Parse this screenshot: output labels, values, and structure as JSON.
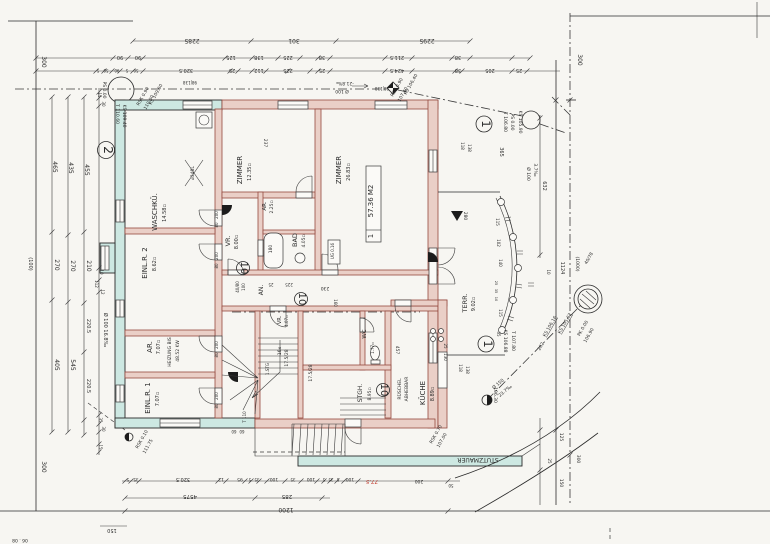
{
  "document": {
    "kind": "scanned architectural floor plan, ground floor, rotated scan"
  },
  "colors": {
    "paper": "#f7f6f2",
    "ink": "#2b2b2b",
    "exterior_wall": "#cde8e2",
    "interior_wall": "#eacfc7",
    "wall_edge": "#94493f",
    "red_mark": "#c0392b"
  },
  "apartment_box": {
    "line_area": "57.36 M2",
    "line_no": "1"
  },
  "circled_marks": [
    {
      "t": "2",
      "x": 106,
      "y": 150,
      "r": 8.5
    },
    {
      "t": "1",
      "x": 484,
      "y": 124,
      "r": 8
    },
    {
      "t": "1",
      "x": 486,
      "y": 344,
      "r": 8
    },
    {
      "t": "10",
      "x": 243,
      "y": 268,
      "r": 6.5
    },
    {
      "t": "10",
      "x": 301,
      "y": 299,
      "r": 6.5
    },
    {
      "t": "10",
      "x": 383,
      "y": 390,
      "r": 6.5
    }
  ],
  "labels": [
    {
      "t": "2285",
      "x": 192,
      "y": 39,
      "r": 180,
      "s": 6
    },
    {
      "t": "301",
      "x": 294,
      "y": 39,
      "r": 180,
      "s": 6
    },
    {
      "t": "2295",
      "x": 427,
      "y": 39,
      "r": 180,
      "s": 6
    },
    {
      "t": "90",
      "x": 120,
      "y": 56,
      "r": 180,
      "s": 5
    },
    {
      "t": "90",
      "x": 138,
      "y": 56,
      "r": 180,
      "s": 5
    },
    {
      "t": "125",
      "x": 231,
      "y": 56,
      "r": 180,
      "s": 5
    },
    {
      "t": "138",
      "x": 259,
      "y": 56,
      "r": 180,
      "s": 5
    },
    {
      "t": "225",
      "x": 288,
      "y": 56,
      "r": 180,
      "s": 5
    },
    {
      "t": "38",
      "x": 322,
      "y": 56,
      "r": 180,
      "s": 5
    },
    {
      "t": "211.5",
      "x": 397,
      "y": 56,
      "r": 180,
      "s": 5
    },
    {
      "t": "38",
      "x": 458,
      "y": 56,
      "r": 180,
      "s": 5
    },
    {
      "t": "5",
      "x": 98,
      "y": 69,
      "r": 180,
      "s": 4
    },
    {
      "t": "50",
      "x": 106,
      "y": 69,
      "r": 180,
      "s": 4
    },
    {
      "t": "90",
      "x": 117,
      "y": 69,
      "r": 180,
      "s": 4
    },
    {
      "t": "5",
      "x": 127,
      "y": 69,
      "r": 180,
      "s": 4
    },
    {
      "t": "50",
      "x": 136,
      "y": 69,
      "r": 180,
      "s": 4
    },
    {
      "t": "320.5",
      "x": 186,
      "y": 69,
      "r": 180,
      "s": 5
    },
    {
      "t": "25",
      "x": 232,
      "y": 69,
      "r": 180,
      "s": 5
    },
    {
      "t": "112",
      "x": 259,
      "y": 69,
      "r": 180,
      "s": 5
    },
    {
      "t": "225",
      "x": 288,
      "y": 69,
      "r": 180,
      "s": 5
    },
    {
      "t": "25",
      "x": 322,
      "y": 69,
      "r": 180,
      "s": 5
    },
    {
      "t": "424.5",
      "x": 397,
      "y": 69,
      "r": 180,
      "s": 5
    },
    {
      "t": "38",
      "x": 458,
      "y": 69,
      "r": 180,
      "s": 5
    },
    {
      "t": "205",
      "x": 490,
      "y": 69,
      "r": 180,
      "s": 5
    },
    {
      "t": "25",
      "x": 519,
      "y": 69,
      "r": 180,
      "s": 5
    },
    {
      "t": "98|138",
      "x": 190,
      "y": 81,
      "r": 180,
      "s": 4
    },
    {
      "t": "98|138",
      "x": 382,
      "y": 87,
      "r": 180,
      "s": 4
    },
    {
      "t": "300",
      "x": 42,
      "y": 62,
      "r": 90,
      "s": 6
    },
    {
      "t": "465",
      "x": 53,
      "y": 167,
      "r": 90,
      "s": 6
    },
    {
      "t": "435",
      "x": 69,
      "y": 168,
      "r": 90,
      "s": 6
    },
    {
      "t": "455",
      "x": 85,
      "y": 170,
      "r": 90,
      "s": 6
    },
    {
      "t": "270",
      "x": 55,
      "y": 265,
      "r": 90,
      "s": 6
    },
    {
      "t": "270",
      "x": 71,
      "y": 266,
      "r": 90,
      "s": 6
    },
    {
      "t": "210",
      "x": 87,
      "y": 266,
      "r": 90,
      "s": 6
    },
    {
      "t": "405",
      "x": 55,
      "y": 365,
      "r": 90,
      "s": 6
    },
    {
      "t": "545",
      "x": 71,
      "y": 365,
      "r": 90,
      "s": 6
    },
    {
      "t": "220.5",
      "x": 87,
      "y": 326,
      "r": 90,
      "s": 5
    },
    {
      "t": "220.5",
      "x": 87,
      "y": 386,
      "r": 90,
      "s": 5
    },
    {
      "t": "300",
      "x": 42,
      "y": 467,
      "r": 90,
      "s": 6
    },
    {
      "t": "(100)",
      "x": 29,
      "y": 264,
      "r": 90,
      "s": 5
    },
    {
      "t": "Ø 100  16.8‰",
      "x": 104,
      "y": 330,
      "r": 90,
      "s": 5
    },
    {
      "t": "15",
      "x": 98,
      "y": 95,
      "r": 90,
      "s": 4
    },
    {
      "t": "30",
      "x": 102,
      "y": 104,
      "r": 90,
      "s": 4
    },
    {
      "t": "10",
      "x": 100,
      "y": 272,
      "r": 90,
      "s": 4
    },
    {
      "t": "112",
      "x": 95,
      "y": 284,
      "r": 90,
      "s": 4
    },
    {
      "t": "12",
      "x": 101,
      "y": 292,
      "r": 90,
      "s": 4
    },
    {
      "t": "35",
      "x": 99,
      "y": 420,
      "r": 90,
      "s": 4
    },
    {
      "t": "30",
      "x": 102,
      "y": 429,
      "r": 90,
      "s": 4
    },
    {
      "t": "15",
      "x": 99,
      "y": 447,
      "r": 90,
      "s": 4
    },
    {
      "t": "PS 0.00",
      "x": 103,
      "y": 90,
      "r": 90,
      "s": 4.5
    },
    {
      "t": "T 110.60",
      "x": 116,
      "y": 114,
      "r": 90,
      "s": 4.5
    },
    {
      "t": "KS 109.40",
      "x": 123,
      "y": 116,
      "r": 90,
      "s": 4.5
    },
    {
      "t": "RSK 0.90",
      "x": 144,
      "y": 97,
      "r": -60,
      "s": 4.5
    },
    {
      "t": "110.00",
      "x": 150,
      "y": 103,
      "r": -60,
      "s": 4.5
    },
    {
      "t": "KS 109.60",
      "x": 157,
      "y": 95,
      "r": -60,
      "s": 4.5
    },
    {
      "t": "Ø 100",
      "x": 342,
      "y": 90,
      "r": 180,
      "s": 4.5
    },
    {
      "t": "-21.8‰",
      "x": 345,
      "y": 82,
      "r": 180,
      "s": 4.5
    },
    {
      "t": "RSK 0.90",
      "x": 398,
      "y": 88,
      "r": -60,
      "s": 4.5
    },
    {
      "t": "107.40",
      "x": 404,
      "y": 95,
      "r": -60,
      "s": 4.5
    },
    {
      "t": "KS 106.40",
      "x": 412,
      "y": 85,
      "r": -60,
      "s": 4.5
    },
    {
      "t": "T 106.80",
      "x": 504,
      "y": 122,
      "r": 90,
      "s": 4.5
    },
    {
      "t": "PS 0.00",
      "x": 511,
      "y": 122,
      "r": 90,
      "s": 4.5
    },
    {
      "t": "KS 105.90",
      "x": 519,
      "y": 122,
      "r": 90,
      "s": 4.5
    },
    {
      "t": "300",
      "x": 578,
      "y": 60,
      "r": 90,
      "s": 6
    },
    {
      "t": "365",
      "x": 500,
      "y": 152,
      "r": 90,
      "s": 5
    },
    {
      "t": "Ø 100",
      "x": 527,
      "y": 174,
      "r": 90,
      "s": 4.5
    },
    {
      "t": "3.7‰",
      "x": 534,
      "y": 170,
      "r": 90,
      "s": 4.5
    },
    {
      "t": "632",
      "x": 543,
      "y": 186,
      "r": 90,
      "s": 5
    },
    {
      "t": "118",
      "x": 461,
      "y": 146,
      "r": 90,
      "s": 4
    },
    {
      "t": "138",
      "x": 468,
      "y": 148,
      "r": 90,
      "s": 4
    },
    {
      "t": "WASCHKÜ.",
      "x": 157,
      "y": 212,
      "r": -90,
      "s": 7
    },
    {
      "t": "14.58▫",
      "x": 166,
      "y": 213,
      "r": -90,
      "s": 5
    },
    {
      "t": "ZIMMER",
      "x": 242,
      "y": 170,
      "r": -90,
      "s": 7
    },
    {
      "t": "12.35▫",
      "x": 251,
      "y": 172,
      "r": -90,
      "s": 5
    },
    {
      "t": "ZIMMER",
      "x": 341,
      "y": 170,
      "r": -90,
      "s": 7
    },
    {
      "t": "26.83▫",
      "x": 350,
      "y": 172,
      "r": -90,
      "s": 5
    },
    {
      "t": "EINL.R. 2",
      "x": 147,
      "y": 263,
      "r": -90,
      "s": 7
    },
    {
      "t": "8.62▫",
      "x": 156,
      "y": 264,
      "r": -90,
      "s": 5
    },
    {
      "t": "AR.",
      "x": 152,
      "y": 347,
      "r": -90,
      "s": 7
    },
    {
      "t": "7.07▫",
      "x": 160,
      "y": 347,
      "r": -90,
      "s": 5
    },
    {
      "t": "HEIZUNG BIS",
      "x": 171,
      "y": 352,
      "r": -90,
      "s": 4.5
    },
    {
      "t": "48.52 KW",
      "x": 179,
      "y": 351,
      "r": -90,
      "s": 4.5
    },
    {
      "t": "EINL.R. 1",
      "x": 150,
      "y": 398,
      "r": -90,
      "s": 7
    },
    {
      "t": "7.07▫",
      "x": 159,
      "y": 399,
      "r": -90,
      "s": 5
    },
    {
      "t": "VR.",
      "x": 230,
      "y": 241,
      "r": -90,
      "s": 6.5
    },
    {
      "t": "8.00▫",
      "x": 238,
      "y": 242,
      "r": -90,
      "s": 5
    },
    {
      "t": "AR.",
      "x": 266,
      "y": 206,
      "r": -90,
      "s": 5.5
    },
    {
      "t": "2.25▫",
      "x": 273,
      "y": 207,
      "r": -90,
      "s": 4.5
    },
    {
      "t": "BAD",
      "x": 297,
      "y": 240,
      "r": -90,
      "s": 6.5
    },
    {
      "t": "4.05▫",
      "x": 305,
      "y": 241,
      "r": -90,
      "s": 4.5
    },
    {
      "t": "AN.",
      "x": 263,
      "y": 290,
      "r": -90,
      "s": 6
    },
    {
      "t": "VR.",
      "x": 281,
      "y": 320,
      "r": -90,
      "s": 5
    },
    {
      "t": "4.07▫",
      "x": 288,
      "y": 321,
      "r": -90,
      "s": 4
    },
    {
      "t": "WC",
      "x": 366,
      "y": 334,
      "r": -90,
      "s": 5.5
    },
    {
      "t": "1.77▫",
      "x": 374,
      "y": 348,
      "r": -90,
      "s": 4
    },
    {
      "t": "STGH.",
      "x": 362,
      "y": 393,
      "r": -90,
      "s": 6
    },
    {
      "t": "8.95▫",
      "x": 371,
      "y": 394,
      "r": -90,
      "s": 4.5
    },
    {
      "t": "KÜCHE",
      "x": 425,
      "y": 393,
      "r": -90,
      "s": 7
    },
    {
      "t": "8.89▫",
      "x": 434,
      "y": 394,
      "r": -90,
      "s": 5
    },
    {
      "t": "TERR.",
      "x": 467,
      "y": 303,
      "r": -90,
      "s": 6.5
    },
    {
      "t": "9.02▫",
      "x": 475,
      "y": 304,
      "r": -90,
      "s": 5
    },
    {
      "t": "RÜSCHEL",
      "x": 401,
      "y": 389,
      "r": -90,
      "s": 4.5
    },
    {
      "t": "ABHEBBAR",
      "x": 408,
      "y": 389,
      "r": -90,
      "s": 4.5
    },
    {
      "t": "⌀348L",
      "x": 194,
      "y": 173,
      "r": -90,
      "s": 4.5
    },
    {
      "t": "180",
      "x": 272,
      "y": 249,
      "r": -90,
      "s": 4.5
    },
    {
      "t": "UG 0.16",
      "x": 334,
      "y": 251,
      "r": -90,
      "s": 4
    },
    {
      "t": "57.36 M2",
      "x": 373,
      "y": 201,
      "r": -90,
      "s": 7
    },
    {
      "t": "1",
      "x": 373,
      "y": 236,
      "r": -90,
      "s": 7
    },
    {
      "t": "237",
      "x": 264,
      "y": 143,
      "r": 90,
      "s": 4.5
    },
    {
      "t": "230",
      "x": 325,
      "y": 287,
      "r": 180,
      "s": 4.5
    },
    {
      "t": "225",
      "x": 289,
      "y": 283,
      "r": 180,
      "s": 4
    },
    {
      "t": "25",
      "x": 271,
      "y": 283,
      "r": 180,
      "s": 4
    },
    {
      "t": "160",
      "x": 334,
      "y": 303,
      "r": 90,
      "s": 4
    },
    {
      "t": "457",
      "x": 396,
      "y": 350,
      "r": 90,
      "s": 4.5
    },
    {
      "t": "130",
      "x": 444,
      "y": 357,
      "r": 90,
      "s": 4
    },
    {
      "t": "25",
      "x": 444,
      "y": 346,
      "r": 90,
      "s": 4
    },
    {
      "t": "200",
      "x": 218,
      "y": 215,
      "r": -90,
      "s": 4
    },
    {
      "t": "80",
      "x": 218,
      "y": 225,
      "r": -90,
      "s": 4
    },
    {
      "t": "200",
      "x": 218,
      "y": 256,
      "r": -90,
      "s": 4
    },
    {
      "t": "80",
      "x": 218,
      "y": 266,
      "r": -90,
      "s": 4
    },
    {
      "t": "200",
      "x": 218,
      "y": 345,
      "r": -90,
      "s": 4
    },
    {
      "t": "80",
      "x": 218,
      "y": 355,
      "r": -90,
      "s": 4
    },
    {
      "t": "200",
      "x": 218,
      "y": 396,
      "r": -90,
      "s": 4
    },
    {
      "t": "80",
      "x": 218,
      "y": 406,
      "r": -90,
      "s": 4
    },
    {
      "t": "40/80",
      "x": 239,
      "y": 287,
      "r": -90,
      "s": 4
    },
    {
      "t": "100",
      "x": 245,
      "y": 287,
      "r": -90,
      "s": 4
    },
    {
      "t": "16x",
      "x": 281,
      "y": 351,
      "r": -90,
      "s": 4.5
    },
    {
      "t": "17.5/28",
      "x": 288,
      "y": 358,
      "r": -90,
      "s": 4.5
    },
    {
      "t": "1.STG",
      "x": 269,
      "y": 369,
      "r": -90,
      "s": 4
    },
    {
      "t": "17.5/28",
      "x": 312,
      "y": 373,
      "r": -90,
      "s": 4.5
    },
    {
      "t": "T 110",
      "x": 246,
      "y": 417,
      "r": -90,
      "s": 4
    },
    {
      "t": "60",
      "x": 234,
      "y": 430,
      "r": 180,
      "s": 4
    },
    {
      "t": "60",
      "x": 242,
      "y": 430,
      "r": 180,
      "s": 4
    },
    {
      "t": "280",
      "x": 464,
      "y": 216,
      "r": 90,
      "s": 4.5
    },
    {
      "t": "115",
      "x": 496,
      "y": 222,
      "r": 90,
      "s": 4
    },
    {
      "t": "102",
      "x": 497,
      "y": 243,
      "r": 90,
      "s": 4
    },
    {
      "t": "140",
      "x": 499,
      "y": 263,
      "r": 90,
      "s": 4
    },
    {
      "t": "25",
      "x": 495,
      "y": 283,
      "r": 90,
      "s": 3.5
    },
    {
      "t": "35",
      "x": 495,
      "y": 291,
      "r": 90,
      "s": 3.5
    },
    {
      "t": "10",
      "x": 495,
      "y": 299,
      "r": 90,
      "s": 3.5
    },
    {
      "t": "115",
      "x": 499,
      "y": 313,
      "r": 90,
      "s": 4
    },
    {
      "t": "35",
      "x": 497,
      "y": 334,
      "r": 90,
      "s": 4
    },
    {
      "t": "1124",
      "x": 561,
      "y": 268,
      "r": 90,
      "s": 5
    },
    {
      "t": "(1000)",
      "x": 576,
      "y": 264,
      "r": 90,
      "s": 4.5
    },
    {
      "t": "10",
      "x": 547,
      "y": 272,
      "r": 90,
      "s": 4
    },
    {
      "t": "40/78",
      "x": 590,
      "y": 259,
      "r": -60,
      "s": 4.5
    },
    {
      "t": "KS 105.62",
      "x": 566,
      "y": 324,
      "r": -60,
      "s": 4.5,
      "c": "u"
    },
    {
      "t": "KS 106.16",
      "x": 551,
      "y": 327,
      "r": -60,
      "s": 4.5,
      "c": "u"
    },
    {
      "t": "282",
      "x": 542,
      "y": 347,
      "r": -60,
      "s": 4.5
    },
    {
      "t": "PK 0.00",
      "x": 584,
      "y": 329,
      "r": -60,
      "s": 4.5
    },
    {
      "t": "106.90",
      "x": 590,
      "y": 336,
      "r": -60,
      "s": 4.5
    },
    {
      "t": "KS 106.88",
      "x": 504,
      "y": 341,
      "r": 90,
      "s": 4.5
    },
    {
      "t": "T 107.80",
      "x": 512,
      "y": 341,
      "r": 90,
      "s": 4.5
    },
    {
      "t": "118",
      "x": 459,
      "y": 368,
      "r": 90,
      "s": 4
    },
    {
      "t": "138",
      "x": 466,
      "y": 370,
      "r": 90,
      "s": 4
    },
    {
      "t": "106.30",
      "x": 494,
      "y": 395,
      "r": 90,
      "s": 4.5
    },
    {
      "t": "Ø 150",
      "x": 499,
      "y": 385,
      "r": -40,
      "s": 4.5
    },
    {
      "t": "23.7‰",
      "x": 506,
      "y": 392,
      "r": -40,
      "s": 4.5
    },
    {
      "t": "RSK 0.70",
      "x": 437,
      "y": 435,
      "r": -60,
      "s": 4.5
    },
    {
      "t": "107.00",
      "x": 443,
      "y": 441,
      "r": -60,
      "s": 4.5
    },
    {
      "t": "RSK 0.10",
      "x": 143,
      "y": 440,
      "r": -60,
      "s": 4.5
    },
    {
      "t": "111.75",
      "x": 149,
      "y": 447,
      "r": -60,
      "s": 4.5
    },
    {
      "t": "STUTZMAUER",
      "x": 478,
      "y": 458,
      "r": 180,
      "s": 6
    },
    {
      "t": "125",
      "x": 560,
      "y": 437,
      "r": 90,
      "s": 4.5
    },
    {
      "t": "25",
      "x": 548,
      "y": 461,
      "r": 90,
      "s": 4
    },
    {
      "t": "150",
      "x": 560,
      "y": 483,
      "r": 90,
      "s": 4.5
    },
    {
      "t": "300",
      "x": 577,
      "y": 459,
      "r": 90,
      "s": 4.5
    },
    {
      "t": "5",
      "x": 128,
      "y": 478,
      "r": 180,
      "s": 4
    },
    {
      "t": "35",
      "x": 136,
      "y": 478,
      "r": 180,
      "s": 4
    },
    {
      "t": "320.5",
      "x": 183,
      "y": 478,
      "r": 180,
      "s": 5
    },
    {
      "t": "12",
      "x": 221,
      "y": 478,
      "r": 180,
      "s": 4.5
    },
    {
      "t": "95",
      "x": 240,
      "y": 478,
      "r": 180,
      "s": 4.5
    },
    {
      "t": "5",
      "x": 250,
      "y": 478,
      "r": 180,
      "s": 4
    },
    {
      "t": "35",
      "x": 257,
      "y": 478,
      "r": 180,
      "s": 4
    },
    {
      "t": "100",
      "x": 274,
      "y": 478,
      "r": 180,
      "s": 4.5
    },
    {
      "t": "35",
      "x": 293,
      "y": 478,
      "r": 180,
      "s": 4
    },
    {
      "t": "100",
      "x": 311,
      "y": 478,
      "r": 180,
      "s": 4.5
    },
    {
      "t": "5",
      "x": 324,
      "y": 478,
      "r": 180,
      "s": 4
    },
    {
      "t": "35",
      "x": 331,
      "y": 478,
      "r": 180,
      "s": 4
    },
    {
      "t": "5",
      "x": 338,
      "y": 478,
      "r": 180,
      "s": 4
    },
    {
      "t": "100",
      "x": 350,
      "y": 478,
      "r": 180,
      "s": 4.5
    },
    {
      "t": "77.5",
      "x": 372,
      "y": 480,
      "r": 180,
      "s": 5.5,
      "c": "red"
    },
    {
      "t": "200",
      "x": 419,
      "y": 480,
      "r": 180,
      "s": 4.5
    },
    {
      "t": "50",
      "x": 451,
      "y": 484,
      "r": 180,
      "s": 4
    },
    {
      "t": "4575",
      "x": 190,
      "y": 495,
      "r": 180,
      "s": 5.5
    },
    {
      "t": "285",
      "x": 287,
      "y": 495,
      "r": 180,
      "s": 5.5
    },
    {
      "t": "1200",
      "x": 286,
      "y": 508,
      "r": 180,
      "s": 6
    },
    {
      "t": "150",
      "x": 112,
      "y": 529,
      "r": 180,
      "s": 5
    },
    {
      "t": "06 . 08",
      "x": 20,
      "y": 539,
      "r": 180,
      "s": 4.5
    }
  ]
}
